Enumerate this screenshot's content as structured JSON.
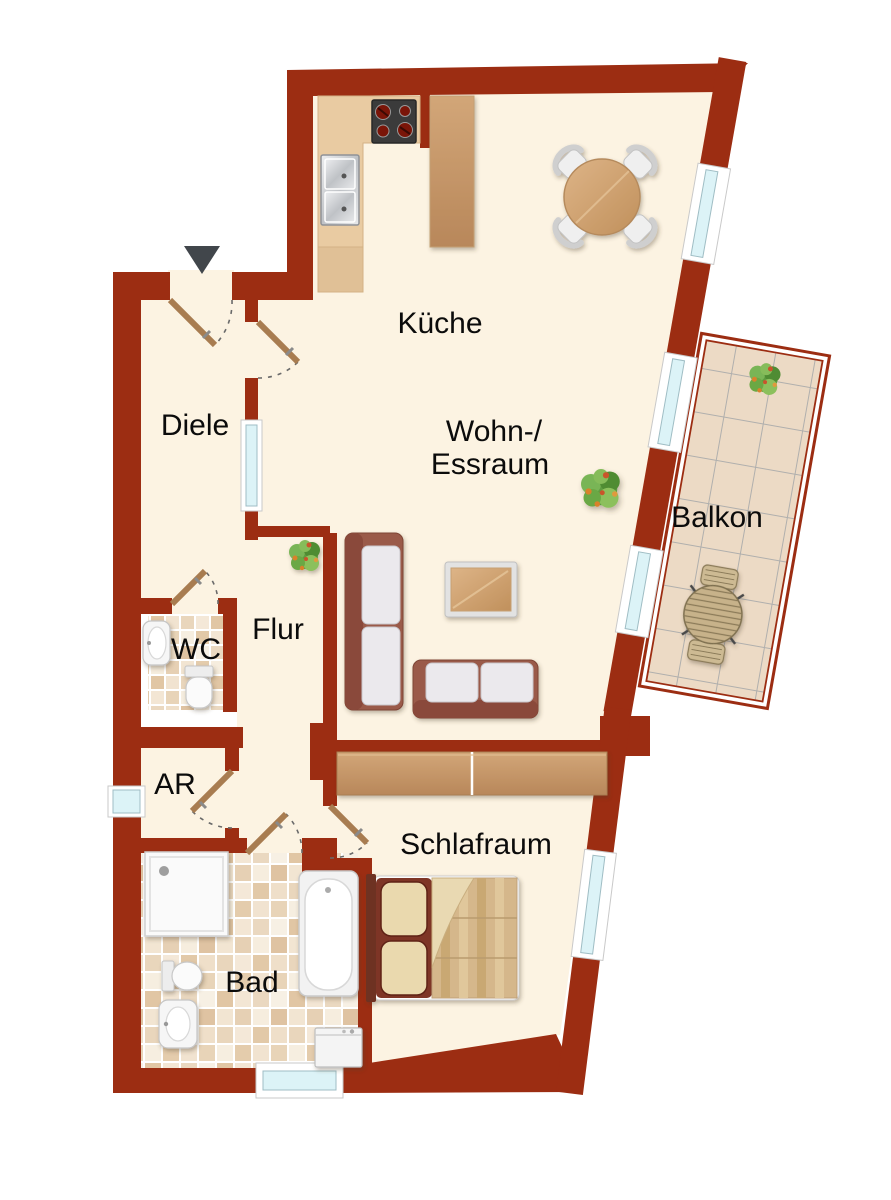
{
  "plan_type": "apartment-floor-plan",
  "rooms": {
    "kueche": {
      "label": "Küche"
    },
    "wohnraum": {
      "label_line1": "Wohn-/",
      "label_line2": "Essraum"
    },
    "diele": {
      "label": "Diele"
    },
    "flur": {
      "label": "Flur"
    },
    "wc": {
      "label": "WC"
    },
    "ar": {
      "label": "AR"
    },
    "bad": {
      "label": "Bad"
    },
    "schlafraum": {
      "label": "Schlafraum"
    },
    "balkon": {
      "label": "Balkon"
    }
  },
  "entrance": {
    "marker": "arrow-down"
  },
  "colors": {
    "wall": "#9C2D12",
    "floor": "#FCF3E2",
    "outside": "#FFFFFF",
    "glazing": "#DCF3F7",
    "glazing_stroke": "#9FBDC4",
    "door_leaf": "#A87C50",
    "balcony_tile": "#ECDAC5",
    "label_text": "#0B0B0B"
  },
  "furniture": {
    "kueche": [
      "kitchen-counter",
      "stove",
      "double-sink",
      "kitchen-island",
      "dining-table",
      "dining-chairs"
    ],
    "wohnraum": [
      "sofa-vertical",
      "sofa-horizontal",
      "coffee-table",
      "plant"
    ],
    "flur": [
      "plant"
    ],
    "balkon": [
      "plant",
      "bistro-table",
      "bistro-chairs"
    ],
    "schlafraum": [
      "wardrobe",
      "double-bed"
    ],
    "bad": [
      "shower",
      "bathtub",
      "toilet",
      "bidet",
      "washing-machine"
    ],
    "wc": [
      "washbasin",
      "toilet"
    ]
  }
}
